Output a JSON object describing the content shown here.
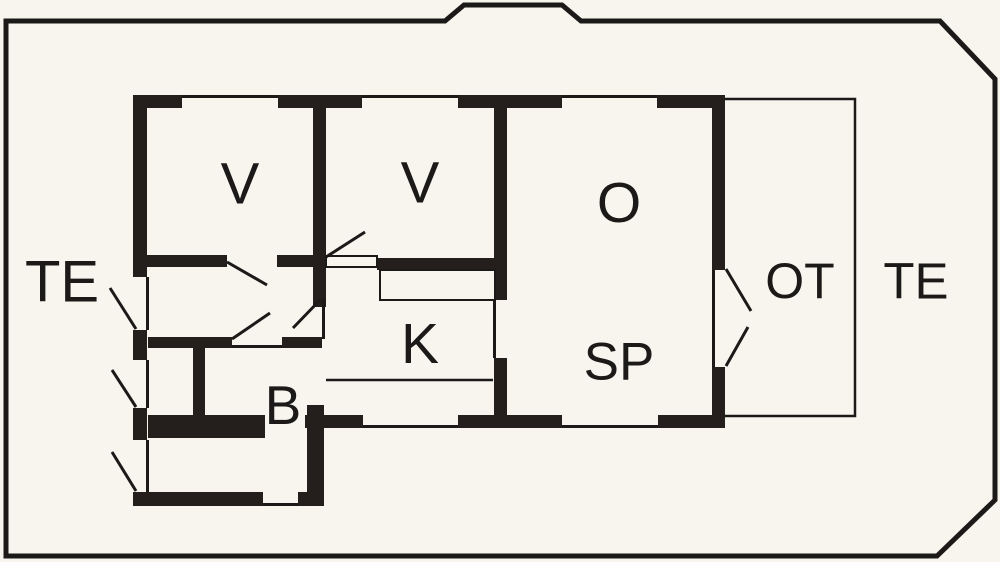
{
  "title": "Holiday home floor plan",
  "canvas": {
    "width": 1000,
    "height": 562,
    "background_color": "#f7f5ee"
  },
  "colors": {
    "wall": "#241f1c",
    "line": "#1c1a18"
  },
  "boundary": {
    "name": "plot-boundary",
    "points": "6,21 445,21 464,5 562,5 581,21 940,21 995,79 995,500 937,556 6,556",
    "stroke_width": 5
  },
  "terrace": {
    "name": "terrace-outline",
    "path": "M724,99 H855 V416 H724",
    "stroke_width": 2.5
  },
  "labels": [
    {
      "id": "te-left",
      "text": "TE",
      "x": 62,
      "y": 282,
      "font_size": 58
    },
    {
      "id": "v1",
      "text": "V",
      "x": 240,
      "y": 184,
      "font_size": 58
    },
    {
      "id": "v2",
      "text": "V",
      "x": 420,
      "y": 183,
      "font_size": 58
    },
    {
      "id": "o",
      "text": "O",
      "x": 619,
      "y": 203,
      "font_size": 57
    },
    {
      "id": "k",
      "text": "K",
      "x": 420,
      "y": 344,
      "font_size": 57
    },
    {
      "id": "sp",
      "text": "SP",
      "x": 619,
      "y": 362,
      "font_size": 53
    },
    {
      "id": "b",
      "text": "B",
      "x": 283,
      "y": 405,
      "font_size": 55
    },
    {
      "id": "ot",
      "text": "OT",
      "x": 800,
      "y": 281,
      "font_size": 50
    },
    {
      "id": "te-right",
      "text": "TE",
      "x": 916,
      "y": 281,
      "font_size": 51
    }
  ],
  "walls": [
    [
      133,
      95,
      49,
      13
    ],
    [
      278,
      95,
      84,
      13
    ],
    [
      458,
      95,
      104,
      13
    ],
    [
      657,
      95,
      68,
      13
    ],
    [
      133,
      95,
      14,
      182
    ],
    [
      133,
      330,
      14,
      30
    ],
    [
      133,
      408,
      14,
      32
    ],
    [
      133,
      492,
      14,
      14
    ],
    [
      712,
      95,
      13,
      175
    ],
    [
      712,
      367,
      13,
      61
    ],
    [
      148,
      415,
      117,
      23
    ],
    [
      305,
      415,
      58,
      13
    ],
    [
      458,
      415,
      104,
      13
    ],
    [
      658,
      415,
      67,
      13
    ],
    [
      307,
      405,
      17,
      88
    ],
    [
      133,
      492,
      130,
      14
    ],
    [
      298,
      492,
      26,
      14
    ],
    [
      148,
      337,
      84,
      11
    ],
    [
      282,
      337,
      40,
      11
    ],
    [
      193,
      340,
      12,
      98
    ],
    [
      313,
      95,
      13,
      212
    ],
    [
      147,
      255,
      80,
      12
    ],
    [
      277,
      255,
      36,
      12
    ],
    [
      377,
      258,
      120,
      12
    ],
    [
      494,
      95,
      13,
      205
    ],
    [
      494,
      358,
      13,
      57
    ]
  ],
  "opening_lines": [
    [
      182,
      95,
      96,
      3
    ],
    [
      362,
      95,
      96,
      3
    ],
    [
      562,
      95,
      95,
      3
    ],
    [
      146,
      277,
      3,
      53
    ],
    [
      146,
      360,
      3,
      48
    ],
    [
      146,
      440,
      3,
      52
    ],
    [
      712,
      270,
      3,
      97
    ],
    [
      363,
      425,
      95,
      3
    ],
    [
      562,
      425,
      96,
      3
    ],
    [
      263,
      503,
      35,
      3
    ],
    [
      322,
      299,
      3,
      40
    ],
    [
      493,
      300,
      3,
      58
    ],
    [
      232,
      345,
      50,
      3
    ]
  ],
  "fixture_outlines": [
    {
      "name": "kitchen-counter",
      "rect": [
        380,
        270,
        115,
        30
      ]
    },
    {
      "name": "door-threshold-box",
      "rect": [
        326,
        256,
        51,
        11
      ]
    }
  ],
  "door_swings": [
    {
      "name": "door-swing-v1",
      "x1": 227,
      "y1": 262,
      "x2": 267,
      "y2": 285
    },
    {
      "name": "door-swing-v2",
      "x1": 326,
      "y1": 257,
      "x2": 365,
      "y2": 232
    },
    {
      "name": "door-swing-kitchen",
      "x1": 320,
      "y1": 300,
      "x2": 293,
      "y2": 328
    },
    {
      "name": "door-swing-bathroom",
      "x1": 232,
      "y1": 339,
      "x2": 270,
      "y2": 313
    },
    {
      "name": "door-swing-entry-top",
      "x1": 110,
      "y1": 288,
      "x2": 136,
      "y2": 329
    },
    {
      "name": "door-swing-entry-mid",
      "x1": 112,
      "y1": 370,
      "x2": 136,
      "y2": 407
    },
    {
      "name": "door-swing-entry-bottom",
      "x1": 112,
      "y1": 452,
      "x2": 136,
      "y2": 491
    },
    {
      "name": "door-swing-terrace-upper",
      "x1": 726,
      "y1": 269,
      "x2": 751,
      "y2": 311
    },
    {
      "name": "door-swing-terrace-lower",
      "x1": 726,
      "y1": 366,
      "x2": 748,
      "y2": 327
    }
  ],
  "counter_edge_line": {
    "name": "kitchen-edge-line",
    "x1": 326,
    "y1": 380,
    "x2": 493,
    "y2": 380
  }
}
